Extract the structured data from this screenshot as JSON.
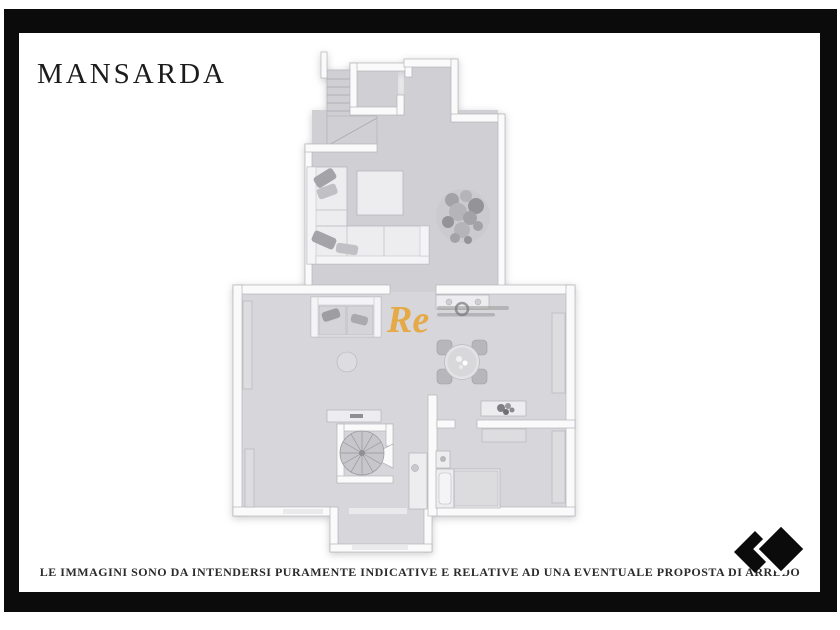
{
  "header": {
    "title": "MANSARDA"
  },
  "watermark": {
    "text": "Re"
  },
  "footer": {
    "disclaimer": "LE IMMAGINI SONO DA INTENDERSI PURAMENTE INDICATIVE E RELATIVE AD UNA EVENTUALE PROPOSTA DI ARREDO"
  },
  "logo": {
    "icon": "double-diamond-icon",
    "color": "#0b0b0b"
  },
  "colors": {
    "frame-color": "#0b0b0b",
    "accent-orange": "#e7a63b",
    "wall-color": "#fafafa",
    "floor-upper": "#cfcfd4",
    "floor-main": "#d7d7db",
    "title-color": "#1c1c1c",
    "disclaimer-color": "#2b2b2b"
  }
}
